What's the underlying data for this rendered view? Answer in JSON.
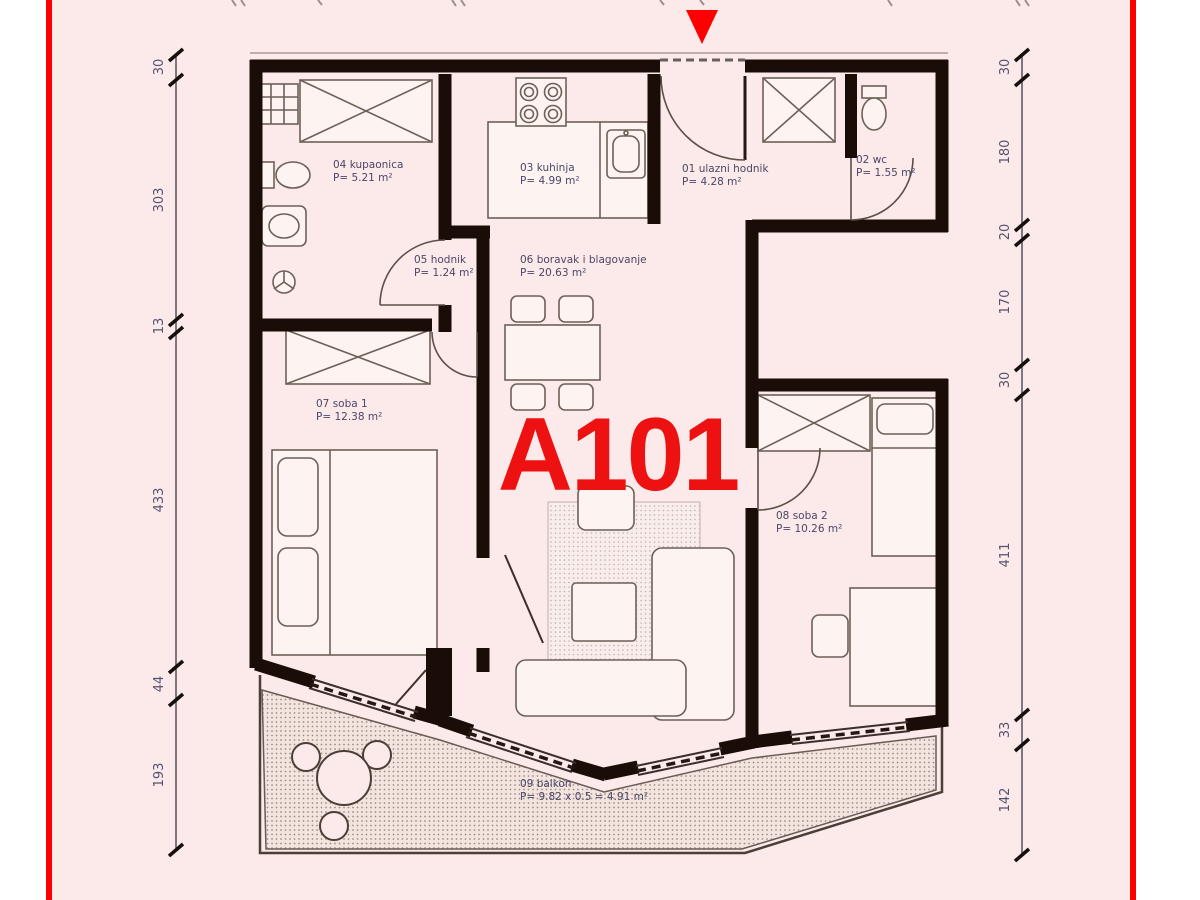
{
  "window": {
    "width": 1200,
    "height": 900
  },
  "colors": {
    "page_margin": "#ffffff",
    "plan_background": "#fce9e9",
    "border_red": "#ff0000",
    "unit_red": "#ee1111",
    "wall_black": "#1a0d08",
    "room_label": "#4a4766",
    "dimension_label": "#555270"
  },
  "unit": {
    "label": "A101"
  },
  "entrance": {
    "marker": "red-triangle-arrow"
  },
  "rooms": [
    {
      "num": "01",
      "name": "01 ulazni hodnik",
      "area": "P= 4.28 m²"
    },
    {
      "num": "02",
      "name": "02 wc",
      "area": "P= 1.55 m²"
    },
    {
      "num": "03",
      "name": "03 kuhinja",
      "area": "P= 4.99 m²"
    },
    {
      "num": "04",
      "name": "04 kupaonica",
      "area": "P= 5.21 m²"
    },
    {
      "num": "05",
      "name": "05 hodnik",
      "area": "P= 1.24 m²"
    },
    {
      "num": "06",
      "name": "06 boravak i blagovanje",
      "area": "P= 20.63 m²"
    },
    {
      "num": "07",
      "name": "07 soba 1",
      "area": "P= 12.38 m²"
    },
    {
      "num": "08",
      "name": "08 soba 2",
      "area": "P= 10.26 m²"
    },
    {
      "num": "09",
      "name": "09 balkon",
      "area": "P= 9.82 x 0.5 = 4.91 m²"
    }
  ],
  "dimensions": {
    "left": [
      "30",
      "303",
      "13",
      "433",
      "44",
      "193"
    ],
    "right": [
      "30",
      "180",
      "20",
      "170",
      "30",
      "411",
      "33",
      "142"
    ]
  }
}
